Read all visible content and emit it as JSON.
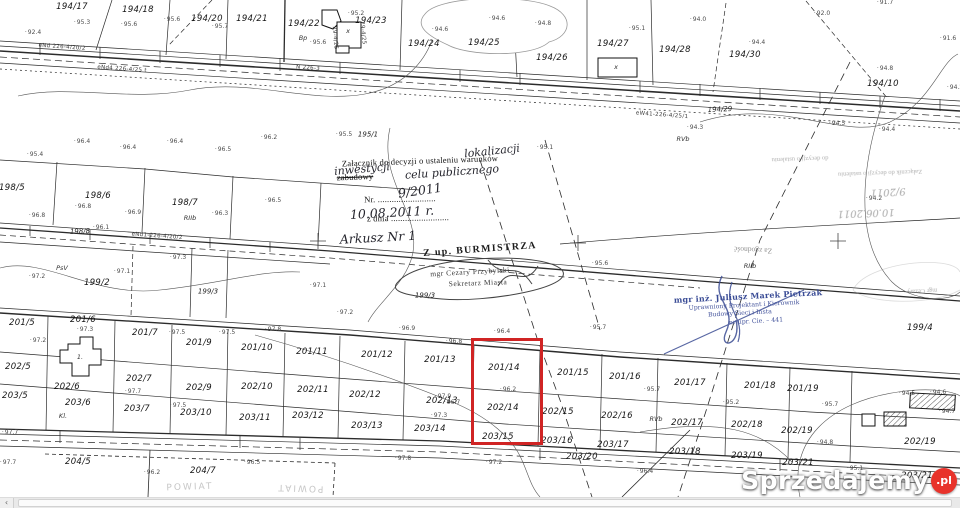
{
  "watermark": {
    "brand": "Sprzedajemy",
    "badge": ".pl"
  },
  "scrollbar": {
    "left_arrow": "‹"
  },
  "highlight": {
    "color": "#d02424"
  },
  "map": {
    "labels": [
      {
        "t": "194/17",
        "x": 72,
        "y": 7,
        "c": "p"
      },
      {
        "t": "194/18",
        "x": 138,
        "y": 10,
        "c": "p"
      },
      {
        "t": "194/20",
        "x": 207,
        "y": 19,
        "c": "p"
      },
      {
        "t": "194/21",
        "x": 252,
        "y": 19,
        "c": "p"
      },
      {
        "t": "194/22",
        "x": 304,
        "y": 24,
        "c": "p"
      },
      {
        "t": "194/23",
        "x": 371,
        "y": 21,
        "c": "p"
      },
      {
        "t": "194/24",
        "x": 424,
        "y": 44,
        "c": "p"
      },
      {
        "t": "194/25",
        "x": 484,
        "y": 43,
        "c": "p"
      },
      {
        "t": "194/26",
        "x": 552,
        "y": 58,
        "c": "p"
      },
      {
        "t": "194/27",
        "x": 613,
        "y": 44,
        "c": "p"
      },
      {
        "t": "194/28",
        "x": 675,
        "y": 50,
        "c": "p"
      },
      {
        "t": "194/30",
        "x": 745,
        "y": 55,
        "c": "p"
      },
      {
        "t": "194/10",
        "x": 883,
        "y": 84,
        "c": "p"
      },
      {
        "t": "194/29",
        "x": 720,
        "y": 110,
        "c": "p2",
        "r": -3
      },
      {
        "t": "195/1",
        "x": 368,
        "y": 135,
        "c": "p2"
      },
      {
        "t": "198/5",
        "x": 12,
        "y": 188,
        "c": "p"
      },
      {
        "t": "198/6",
        "x": 98,
        "y": 196,
        "c": "p"
      },
      {
        "t": "198/7",
        "x": 185,
        "y": 203,
        "c": "p"
      },
      {
        "t": "198/8",
        "x": 80,
        "y": 232,
        "c": "p2",
        "r": -2
      },
      {
        "t": "199/2",
        "x": 97,
        "y": 283,
        "c": "p"
      },
      {
        "t": "199/3",
        "x": 208,
        "y": 292,
        "c": "p2"
      },
      {
        "t": "199/3",
        "x": 425,
        "y": 296,
        "c": "p2"
      },
      {
        "t": "199/4",
        "x": 920,
        "y": 328,
        "c": "p"
      },
      {
        "t": "201/5",
        "x": 22,
        "y": 323,
        "c": "p"
      },
      {
        "t": "201/6",
        "x": 83,
        "y": 320,
        "c": "p"
      },
      {
        "t": "201/7",
        "x": 145,
        "y": 333,
        "c": "p"
      },
      {
        "t": "201/9",
        "x": 199,
        "y": 343,
        "c": "p"
      },
      {
        "t": "201/10",
        "x": 257,
        "y": 348,
        "c": "p"
      },
      {
        "t": "201/11",
        "x": 312,
        "y": 352,
        "c": "p"
      },
      {
        "t": "201/12",
        "x": 377,
        "y": 355,
        "c": "p"
      },
      {
        "t": "201/13",
        "x": 440,
        "y": 360,
        "c": "p"
      },
      {
        "t": "201/14",
        "x": 504,
        "y": 368,
        "c": "p"
      },
      {
        "t": "201/15",
        "x": 573,
        "y": 373,
        "c": "p"
      },
      {
        "t": "201/16",
        "x": 625,
        "y": 377,
        "c": "p"
      },
      {
        "t": "201/17",
        "x": 690,
        "y": 383,
        "c": "p"
      },
      {
        "t": "201/18",
        "x": 760,
        "y": 386,
        "c": "p"
      },
      {
        "t": "201/19",
        "x": 803,
        "y": 389,
        "c": "p"
      },
      {
        "t": "202/5",
        "x": 18,
        "y": 367,
        "c": "p"
      },
      {
        "t": "202/6",
        "x": 67,
        "y": 387,
        "c": "p"
      },
      {
        "t": "202/7",
        "x": 139,
        "y": 379,
        "c": "p"
      },
      {
        "t": "202/9",
        "x": 199,
        "y": 388,
        "c": "p"
      },
      {
        "t": "202/10",
        "x": 257,
        "y": 387,
        "c": "p"
      },
      {
        "t": "202/11",
        "x": 313,
        "y": 390,
        "c": "p"
      },
      {
        "t": "202/12",
        "x": 365,
        "y": 395,
        "c": "p"
      },
      {
        "t": "202/13",
        "x": 442,
        "y": 401,
        "c": "p"
      },
      {
        "t": "202/14",
        "x": 503,
        "y": 408,
        "c": "p"
      },
      {
        "t": "202/15",
        "x": 558,
        "y": 412,
        "c": "p"
      },
      {
        "t": "202/16",
        "x": 617,
        "y": 416,
        "c": "p"
      },
      {
        "t": "202/17",
        "x": 687,
        "y": 423,
        "c": "p"
      },
      {
        "t": "202/18",
        "x": 747,
        "y": 425,
        "c": "p"
      },
      {
        "t": "202/19",
        "x": 797,
        "y": 431,
        "c": "p"
      },
      {
        "t": "202/19",
        "x": 920,
        "y": 442,
        "c": "p"
      },
      {
        "t": "203/5",
        "x": 15,
        "y": 396,
        "c": "p"
      },
      {
        "t": "203/6",
        "x": 78,
        "y": 403,
        "c": "p"
      },
      {
        "t": "203/7",
        "x": 137,
        "y": 409,
        "c": "p"
      },
      {
        "t": "203/10",
        "x": 196,
        "y": 413,
        "c": "p"
      },
      {
        "t": "203/11",
        "x": 255,
        "y": 418,
        "c": "p"
      },
      {
        "t": "203/12",
        "x": 308,
        "y": 416,
        "c": "p"
      },
      {
        "t": "203/13",
        "x": 367,
        "y": 426,
        "c": "p"
      },
      {
        "t": "203/14",
        "x": 430,
        "y": 429,
        "c": "p"
      },
      {
        "t": "203/15",
        "x": 498,
        "y": 437,
        "c": "p"
      },
      {
        "t": "203/16",
        "x": 557,
        "y": 441,
        "c": "p"
      },
      {
        "t": "203/17",
        "x": 613,
        "y": 445,
        "c": "p"
      },
      {
        "t": "203/18",
        "x": 685,
        "y": 452,
        "c": "p"
      },
      {
        "t": "203/19",
        "x": 747,
        "y": 456,
        "c": "p"
      },
      {
        "t": "203/20",
        "x": 582,
        "y": 457,
        "c": "p"
      },
      {
        "t": "203/21",
        "x": 798,
        "y": 463,
        "c": "p"
      },
      {
        "t": "203/21",
        "x": 917,
        "y": 476,
        "c": "p"
      },
      {
        "t": "204/5",
        "x": 78,
        "y": 462,
        "c": "p"
      },
      {
        "t": "204/7",
        "x": 203,
        "y": 471,
        "c": "p"
      },
      {
        "t": "Bp",
        "x": 303,
        "y": 38,
        "c": "s"
      },
      {
        "t": "PsV",
        "x": 62,
        "y": 268,
        "c": "s"
      },
      {
        "t": "RVb",
        "x": 683,
        "y": 139,
        "c": "s"
      },
      {
        "t": "RIIb",
        "x": 190,
        "y": 218,
        "c": "s"
      },
      {
        "t": "Kl.",
        "x": 63,
        "y": 416,
        "c": "s"
      },
      {
        "t": "RVb",
        "x": 656,
        "y": 419,
        "c": "s"
      },
      {
        "t": "RIIb",
        "x": 750,
        "y": 266,
        "c": "s"
      },
      {
        "t": "x",
        "x": 616,
        "y": 67,
        "c": "s"
      },
      {
        "t": "x",
        "x": 348,
        "y": 31,
        "c": "s"
      },
      {
        "t": "1.",
        "x": 80,
        "y": 357,
        "c": "s"
      },
      {
        "t": "95.3",
        "x": 82,
        "y": 23,
        "c": "e"
      },
      {
        "t": "95.6",
        "x": 129,
        "y": 25,
        "c": "e"
      },
      {
        "t": "95.6",
        "x": 172,
        "y": 20,
        "c": "e"
      },
      {
        "t": "95.7",
        "x": 220,
        "y": 27,
        "c": "e"
      },
      {
        "t": "92.4",
        "x": 33,
        "y": 33,
        "c": "e"
      },
      {
        "t": "95.6",
        "x": 318,
        "y": 43,
        "c": "e"
      },
      {
        "t": "95.2",
        "x": 356,
        "y": 14,
        "c": "e"
      },
      {
        "t": "94.6",
        "x": 440,
        "y": 30,
        "c": "e"
      },
      {
        "t": "94.6",
        "x": 497,
        "y": 19,
        "c": "e"
      },
      {
        "t": "94.8",
        "x": 543,
        "y": 24,
        "c": "e"
      },
      {
        "t": "95.1",
        "x": 637,
        "y": 29,
        "c": "e"
      },
      {
        "t": "94.0",
        "x": 698,
        "y": 20,
        "c": "e"
      },
      {
        "t": "94.4",
        "x": 757,
        "y": 43,
        "c": "e"
      },
      {
        "t": "92.0",
        "x": 822,
        "y": 14,
        "c": "e"
      },
      {
        "t": "91.7",
        "x": 885,
        "y": 3,
        "c": "e"
      },
      {
        "t": "91.6",
        "x": 948,
        "y": 39,
        "c": "e"
      },
      {
        "t": "94.8",
        "x": 885,
        "y": 69,
        "c": "e"
      },
      {
        "t": "94.2",
        "x": 955,
        "y": 88,
        "c": "e"
      },
      {
        "t": "94.5",
        "x": 837,
        "y": 124,
        "c": "e"
      },
      {
        "t": "94.4",
        "x": 887,
        "y": 130,
        "c": "e"
      },
      {
        "t": "94.3",
        "x": 695,
        "y": 128,
        "c": "e"
      },
      {
        "t": "96.4",
        "x": 82,
        "y": 142,
        "c": "e"
      },
      {
        "t": "96.4",
        "x": 128,
        "y": 148,
        "c": "e"
      },
      {
        "t": "96.4",
        "x": 175,
        "y": 142,
        "c": "e"
      },
      {
        "t": "96.5",
        "x": 223,
        "y": 150,
        "c": "e"
      },
      {
        "t": "96.2",
        "x": 269,
        "y": 138,
        "c": "e"
      },
      {
        "t": "95.4",
        "x": 35,
        "y": 155,
        "c": "e"
      },
      {
        "t": "96.8",
        "x": 83,
        "y": 207,
        "c": "e"
      },
      {
        "t": "96.9",
        "x": 133,
        "y": 213,
        "c": "e"
      },
      {
        "t": "96.8",
        "x": 37,
        "y": 216,
        "c": "e"
      },
      {
        "t": "96.3",
        "x": 220,
        "y": 214,
        "c": "e"
      },
      {
        "t": "96.5",
        "x": 273,
        "y": 201,
        "c": "e"
      },
      {
        "t": "95.5",
        "x": 344,
        "y": 135,
        "c": "e"
      },
      {
        "t": "95.1",
        "x": 545,
        "y": 148,
        "c": "e"
      },
      {
        "t": "94.2",
        "x": 874,
        "y": 199,
        "c": "e"
      },
      {
        "t": "95.6",
        "x": 600,
        "y": 264,
        "c": "e"
      },
      {
        "t": "96.1",
        "x": 101,
        "y": 228,
        "c": "e"
      },
      {
        "t": "97.2",
        "x": 37,
        "y": 277,
        "c": "e"
      },
      {
        "t": "97.1",
        "x": 122,
        "y": 272,
        "c": "e"
      },
      {
        "t": "97.3",
        "x": 178,
        "y": 258,
        "c": "e"
      },
      {
        "t": "97.1",
        "x": 318,
        "y": 286,
        "c": "e"
      },
      {
        "t": "97.2",
        "x": 345,
        "y": 313,
        "c": "e"
      },
      {
        "t": "96.9",
        "x": 407,
        "y": 329,
        "c": "e"
      },
      {
        "t": "96.8",
        "x": 454,
        "y": 342,
        "c": "e"
      },
      {
        "t": "96.4",
        "x": 502,
        "y": 332,
        "c": "e"
      },
      {
        "t": "95.7",
        "x": 598,
        "y": 328,
        "c": "e"
      },
      {
        "t": "97.2",
        "x": 38,
        "y": 341,
        "c": "e"
      },
      {
        "t": "97.3",
        "x": 85,
        "y": 330,
        "c": "e"
      },
      {
        "t": "97.5",
        "x": 177,
        "y": 333,
        "c": "e"
      },
      {
        "t": "97.5",
        "x": 227,
        "y": 333,
        "c": "e"
      },
      {
        "t": "97.8",
        "x": 273,
        "y": 330,
        "c": "e"
      },
      {
        "t": "97.7",
        "x": 133,
        "y": 392,
        "c": "e"
      },
      {
        "t": "97.5",
        "x": 178,
        "y": 406,
        "c": "e"
      },
      {
        "t": "97.9",
        "x": 443,
        "y": 397,
        "c": "e"
      },
      {
        "t": "96.7",
        "x": 452,
        "y": 403,
        "c": "e"
      },
      {
        "t": "96.2",
        "x": 508,
        "y": 390,
        "c": "e"
      },
      {
        "t": "97.3",
        "x": 439,
        "y": 416,
        "c": "e"
      },
      {
        "t": "95.7",
        "x": 652,
        "y": 390,
        "c": "e"
      },
      {
        "t": "95.2",
        "x": 731,
        "y": 403,
        "c": "e"
      },
      {
        "t": "95.7",
        "x": 830,
        "y": 405,
        "c": "e"
      },
      {
        "t": "94.8",
        "x": 825,
        "y": 443,
        "c": "e"
      },
      {
        "t": "95.1",
        "x": 855,
        "y": 469,
        "c": "e"
      },
      {
        "t": "94.5",
        "x": 907,
        "y": 394,
        "c": "e"
      },
      {
        "t": "94.6",
        "x": 938,
        "y": 393,
        "c": "e"
      },
      {
        "t": "94.7",
        "x": 947,
        "y": 412,
        "c": "e"
      },
      {
        "t": "97.2",
        "x": 494,
        "y": 463,
        "c": "e"
      },
      {
        "t": "96.4",
        "x": 645,
        "y": 472,
        "c": "e"
      },
      {
        "t": "97.7",
        "x": 10,
        "y": 433,
        "c": "e"
      },
      {
        "t": "97.7",
        "x": 8,
        "y": 463,
        "c": "e"
      },
      {
        "t": "96.2",
        "x": 152,
        "y": 473,
        "c": "e"
      },
      {
        "t": "96.5",
        "x": 252,
        "y": 463,
        "c": "e"
      },
      {
        "t": "97.8",
        "x": 403,
        "y": 459,
        "c": "e"
      },
      {
        "t": "eNd 226-4/20/2",
        "x": 62,
        "y": 48,
        "c": "n",
        "r": 4
      },
      {
        "t": "eNd4 226-4/25 t",
        "x": 122,
        "y": 70,
        "c": "n",
        "r": 4
      },
      {
        "t": "N 226-3",
        "x": 308,
        "y": 69,
        "c": "n",
        "r": 4
      },
      {
        "t": "eW41-226-4/25/1",
        "x": 662,
        "y": 116,
        "c": "n",
        "r": 4
      },
      {
        "t": "eNd1-226-4/20/2",
        "x": 157,
        "y": 237,
        "c": "n",
        "r": 4
      },
      {
        "t": "29-4/25",
        "x": 334,
        "y": 38,
        "c": "n",
        "r": 85
      },
      {
        "t": "29-4/25",
        "x": 362,
        "y": 33,
        "c": "n",
        "r": 85
      },
      {
        "t": "Załącznik do decyzji o ustaleniu warunków",
        "x": 420,
        "y": 161,
        "c": "sp",
        "r": -2
      },
      {
        "t": "zabudowy",
        "x": 355,
        "y": 177,
        "c": "sp struck",
        "r": -2
      },
      {
        "t": "lokalizacji",
        "x": 492,
        "y": 151,
        "c": "hd",
        "r": -6
      },
      {
        "t": "inwestycji",
        "x": 362,
        "y": 169,
        "c": "hd",
        "r": -5
      },
      {
        "t": "celu publicznego",
        "x": 452,
        "y": 172,
        "c": "hd",
        "r": -4
      },
      {
        "t": "Nr. .........................",
        "x": 400,
        "y": 199,
        "c": "sp",
        "r": -1
      },
      {
        "t": "9/2011",
        "x": 420,
        "y": 191,
        "c": "hd2",
        "r": -8
      },
      {
        "t": "z dnia .........................",
        "x": 408,
        "y": 218,
        "c": "sp",
        "r": -1
      },
      {
        "t": "10.08.2011 r.",
        "x": 392,
        "y": 213,
        "c": "hd2",
        "r": -3
      },
      {
        "t": "Arkusz Nr 1",
        "x": 378,
        "y": 238,
        "c": "hd2",
        "r": -3
      },
      {
        "t": "Z up. BURMISTRZA",
        "x": 480,
        "y": 250,
        "c": "spb",
        "r": -4
      },
      {
        "t": "mgr Cezary Przybylski",
        "x": 470,
        "y": 272,
        "c": "sps",
        "r": -3
      },
      {
        "t": "Sekretarz Miasta",
        "x": 478,
        "y": 283,
        "c": "sps",
        "r": -2
      },
      {
        "t": "do decyzji o ustaleniu",
        "x": 800,
        "y": 158,
        "c": "gh",
        "r": 178
      },
      {
        "t": "Załącznik do decyzji o ustaleniu",
        "x": 880,
        "y": 172,
        "c": "gh",
        "r": 178
      },
      {
        "t": "9/2011",
        "x": 888,
        "y": 191,
        "c": "ghh",
        "r": 177
      },
      {
        "t": "10.06.2011",
        "x": 866,
        "y": 212,
        "c": "ghh",
        "r": 178
      },
      {
        "t": "Za zgodność",
        "x": 753,
        "y": 250,
        "c": "gh2",
        "r": 183
      },
      {
        "t": "mgr Cezary",
        "x": 922,
        "y": 290,
        "c": "gh",
        "r": 177
      },
      {
        "t": "mgr inż. Juliusz Marek Pietrzak",
        "x": 748,
        "y": 296,
        "c": "bl1",
        "r": -3
      },
      {
        "t": "Uprawniony Projektant i Kierownik",
        "x": 744,
        "y": 306,
        "c": "bl2",
        "r": -3
      },
      {
        "t": "Budowy Sieci i Insta",
        "x": 740,
        "y": 314,
        "c": "bl2",
        "r": -3
      },
      {
        "t": "nr upr. Cie. – 441",
        "x": 756,
        "y": 322,
        "c": "bl2",
        "r": -3
      },
      {
        "t": "POWIAT",
        "x": 190,
        "y": 488,
        "c": "gh3",
        "r": -2
      },
      {
        "t": "POWIAT",
        "x": 300,
        "y": 487,
        "c": "gh3",
        "r": 182
      }
    ]
  }
}
